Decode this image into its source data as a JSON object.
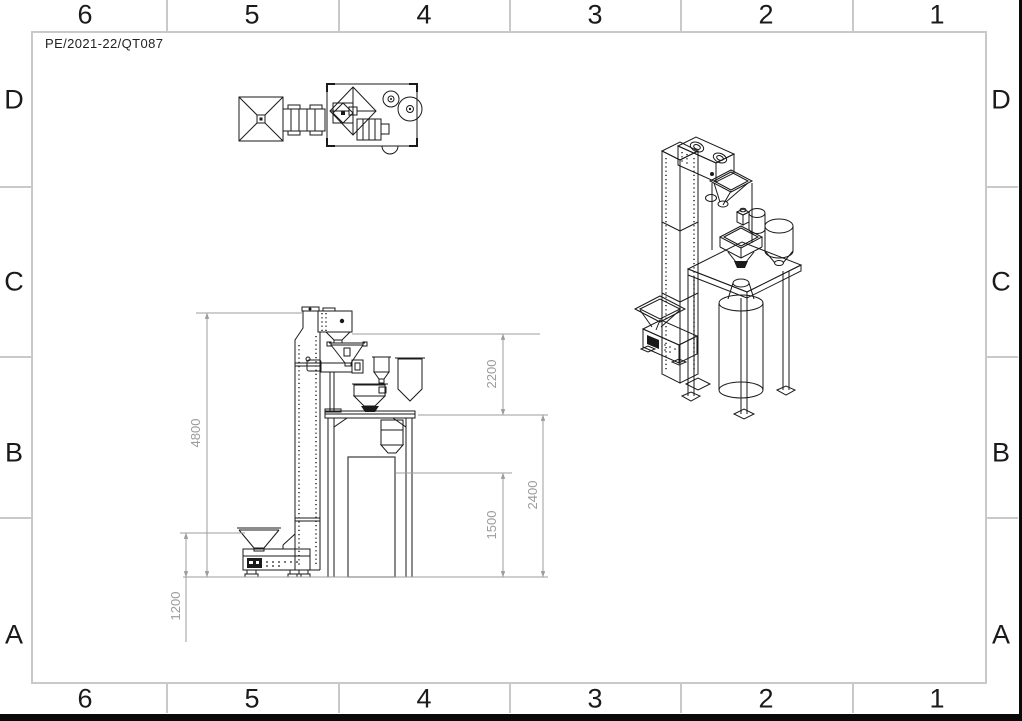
{
  "sheet": {
    "drawing_number": "PE/2021-22/QT087",
    "grid_columns": [
      "6",
      "5",
      "4",
      "3",
      "2",
      "1"
    ],
    "grid_rows": [
      "D",
      "C",
      "B",
      "A"
    ],
    "colors": {
      "drawing_line": "#1a1a1a",
      "dimension_line": "#9c9c9c",
      "frame_border": "#c9c9c9",
      "background": "#ffffff"
    }
  },
  "views": {
    "front": {
      "dimensions": {
        "overall_height": "4800",
        "infeed_height": "1200",
        "discharge_clearance": "2200",
        "bag_frame_height": "1500",
        "platform_height": "2400"
      }
    }
  }
}
